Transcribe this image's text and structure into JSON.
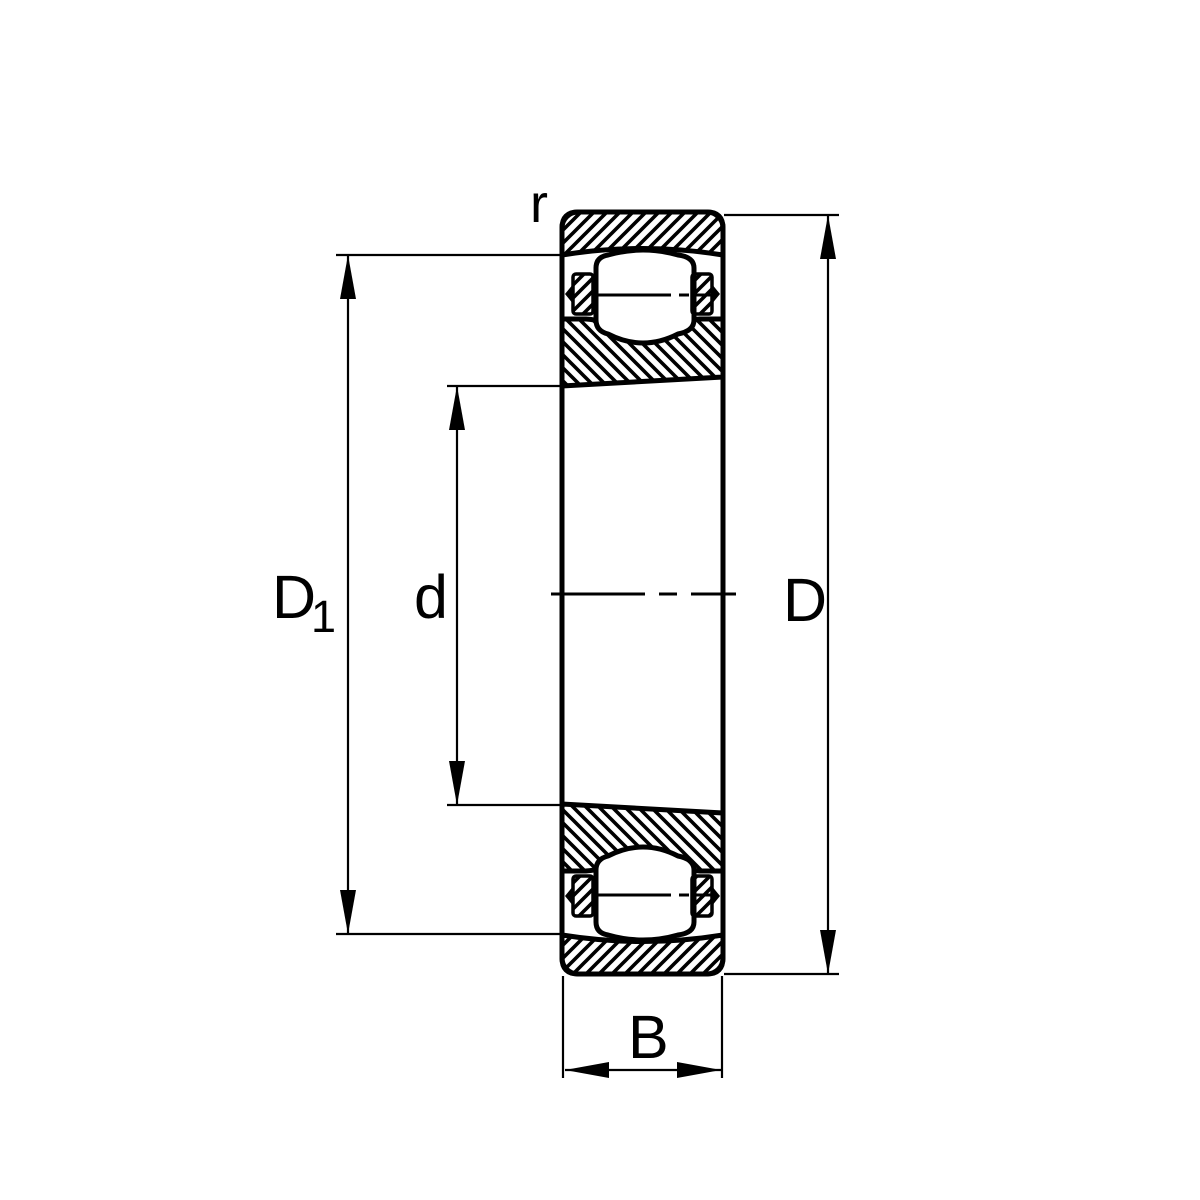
{
  "drawing": {
    "background_color": "#ffffff",
    "line_color": "#000000",
    "labels": {
      "corner_radius": "r",
      "shoulder_diameter_base": "D",
      "shoulder_diameter_subscript": "1",
      "bore_diameter": "d",
      "outside_diameter": "D",
      "width": "B"
    }
  }
}
